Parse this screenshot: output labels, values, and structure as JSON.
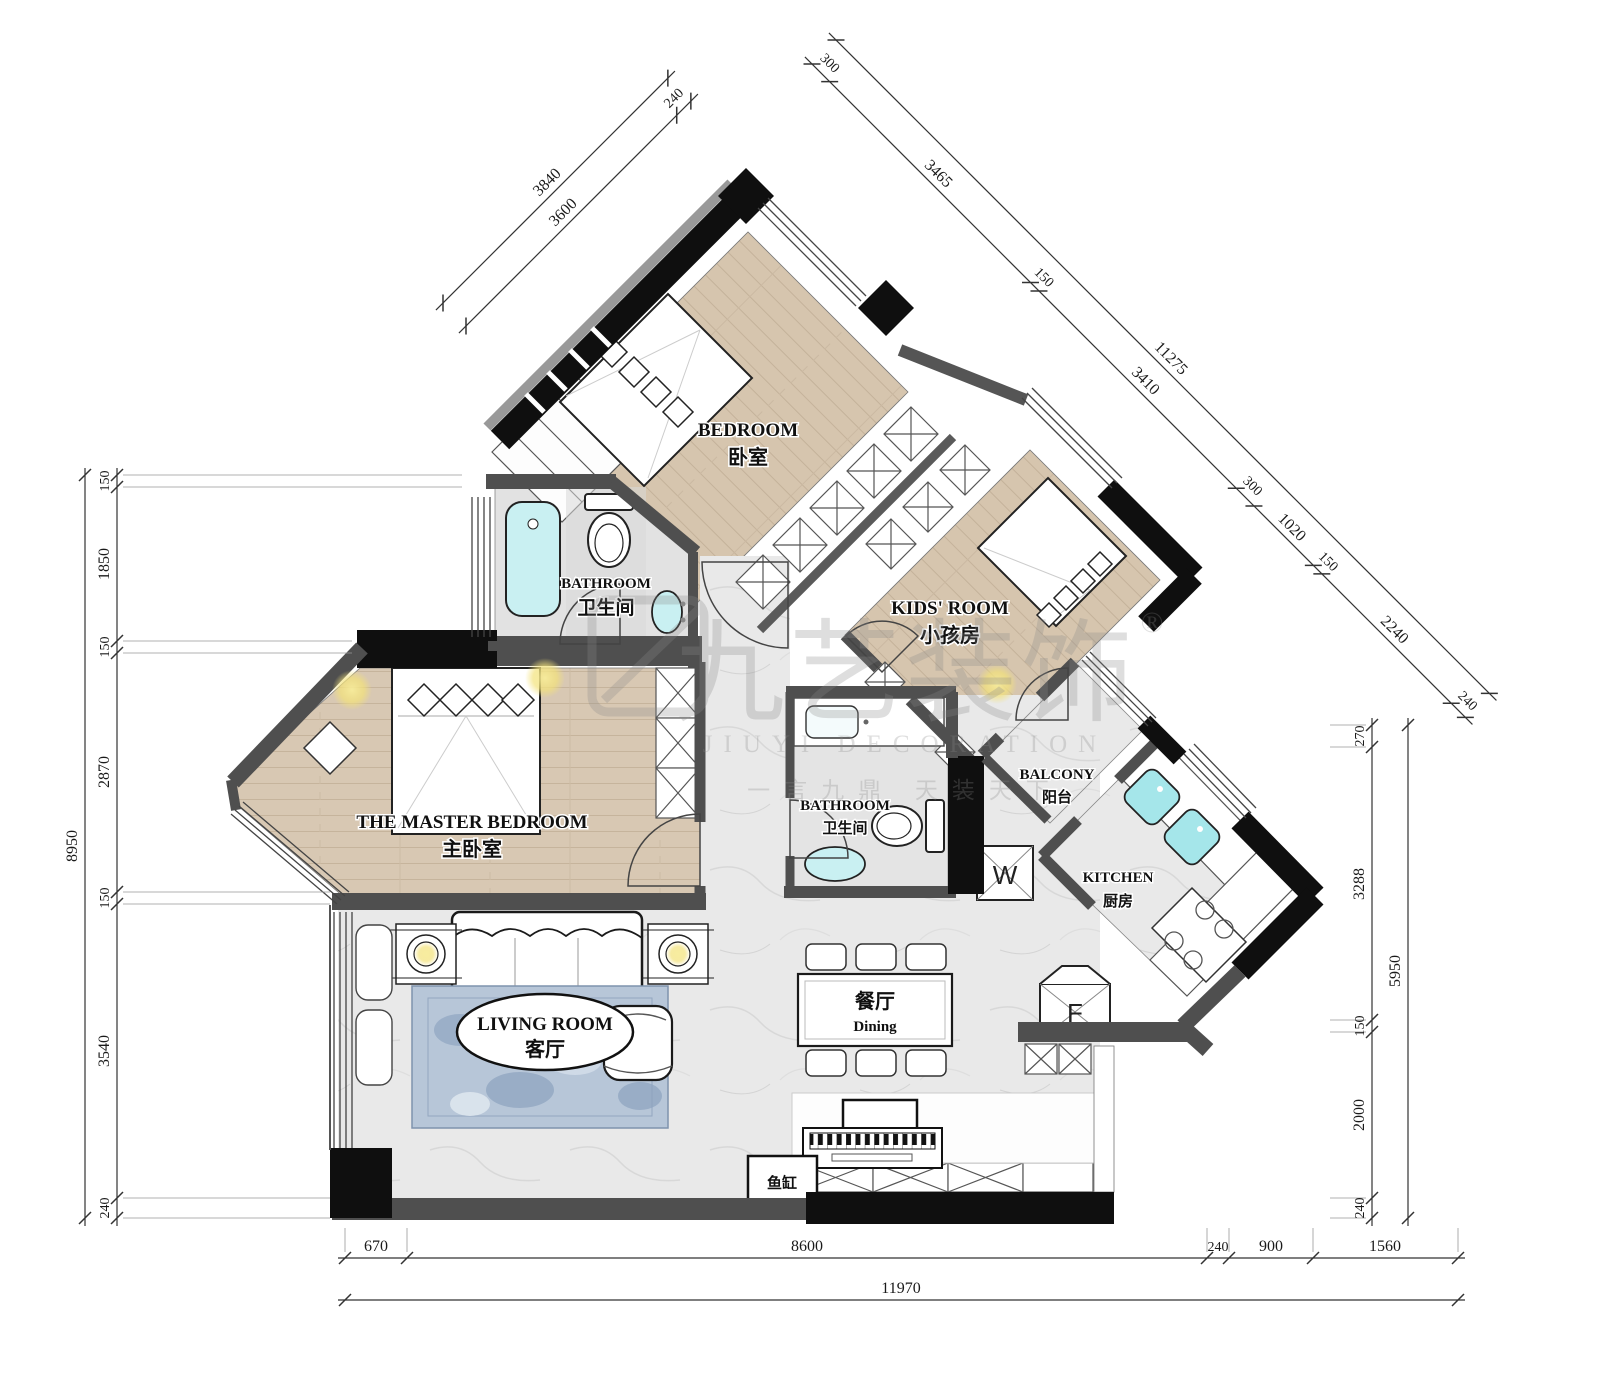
{
  "rooms": {
    "bedroom": {
      "en": "BEDROOM",
      "zh": "卧室"
    },
    "kids_room": {
      "en": "KIDS' ROOM",
      "zh": "小孩房"
    },
    "bathroom_top": {
      "en": "BATHROOM",
      "zh": "卫生间"
    },
    "bathroom_main": {
      "en": "BATHROOM",
      "zh": "卫生间"
    },
    "master_bedroom": {
      "en": "THE MASTER BEDROOM",
      "zh": "主卧室"
    },
    "balcony": {
      "en": "BALCONY",
      "zh": "阳台"
    },
    "kitchen": {
      "en": "KITCHEN",
      "zh": "厨房"
    },
    "living_room": {
      "en": "LIVING ROOM",
      "zh": "客厅"
    },
    "dining": {
      "zh": "餐厅",
      "en": "Dining"
    },
    "fish_tank": {
      "zh": "鱼缸"
    },
    "washer": {
      "label": "W"
    },
    "fridge": {
      "label": "F"
    }
  },
  "dimensions": {
    "top_left": {
      "total": "3840",
      "segments": [
        "3600",
        "240"
      ]
    },
    "top_right": {
      "total": "11275",
      "segments": [
        "300",
        "3465",
        "150",
        "3410",
        "300",
        "1020",
        "150",
        "2240",
        "240"
      ]
    },
    "left": {
      "total": "8950",
      "segments": [
        "150",
        "1850",
        "150",
        "2870",
        "150",
        "3540",
        "240"
      ]
    },
    "right": {
      "total": "5950",
      "segments": [
        "270",
        "3288",
        "150",
        "2000",
        "240"
      ]
    },
    "bottom": {
      "total": "11970",
      "segments": [
        "670",
        "8600",
        "240",
        "900",
        "1560"
      ]
    }
  },
  "watermark": {
    "brand": "九艺装饰",
    "registered": "®",
    "latin": "JIUYI DECORATION",
    "slogan": "一言九鼎 天装天下"
  },
  "colors": {
    "wall_gray": "#4f4f4f",
    "wall_black": "#0f0f0f",
    "wood": "#d8c8b3",
    "marble": "#e9e9e9",
    "fixture_cyan": "#bfeef0",
    "rug_blue": "#b7c6d8",
    "light_yellow": "#f3e27a"
  }
}
